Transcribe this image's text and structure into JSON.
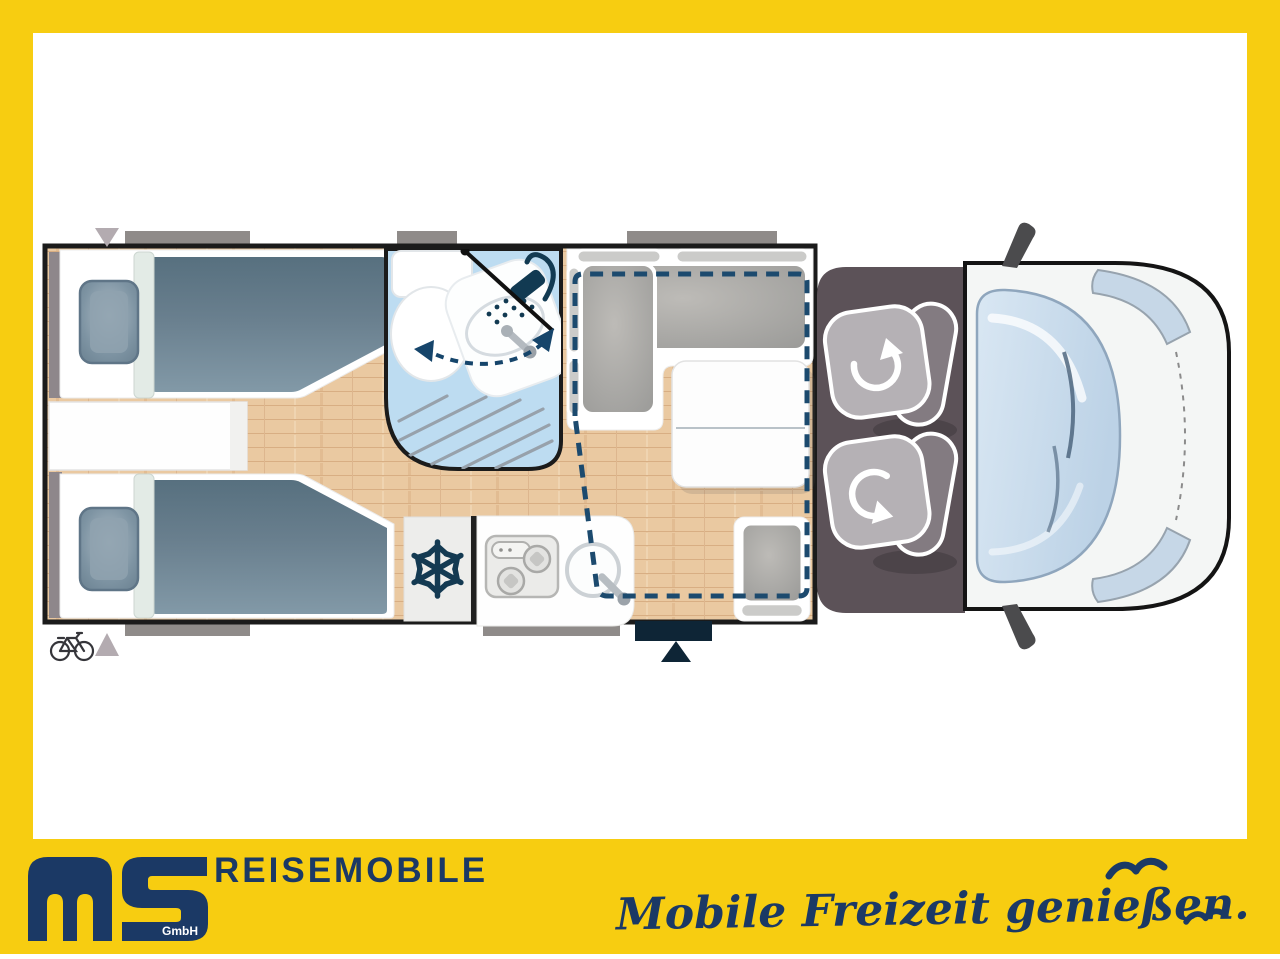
{
  "branding": {
    "wordmark": "REISEMOBILE",
    "logo_suffix": "GmbH",
    "slogan": "Mobile Freizeit genießen.",
    "colors": {
      "brand_yellow": "#F7CD11",
      "brand_navy": "#1B3965"
    }
  },
  "floorplan": {
    "view": "motorhome-top-view",
    "rooms": [
      {
        "name": "rear-twin-bedroom"
      },
      {
        "name": "bathroom"
      },
      {
        "name": "dinette"
      },
      {
        "name": "kitchen"
      },
      {
        "name": "driver-cab"
      }
    ],
    "features": [
      "twin-single-beds-with-pillows",
      "center-step-chest",
      "toilet",
      "vanity-sink",
      "shower-with-swivel-wall",
      "l-shaped-bench",
      "dinette-table",
      "side-seat",
      "drop-down-bed-dashed-outline",
      "refrigerator",
      "two-burner-hob",
      "round-kitchen-sink",
      "swivel-driver-seat",
      "swivel-passenger-seat",
      "windshield",
      "headlights",
      "side-mirrors",
      "entry-door",
      "rear-bike-marker"
    ],
    "colors": {
      "floor_wood": "#EAC9A1",
      "bath_blue": "#BDDCF1",
      "bed_fabric": "#64798A",
      "bench_gray": "#A5A4A1",
      "cab_floor": "#5C5258",
      "wall": "#1B1B1B",
      "window_bar": "#8F8B89",
      "door_navy": "#0E2536",
      "dashed_outline": "#1C4A6E"
    }
  }
}
